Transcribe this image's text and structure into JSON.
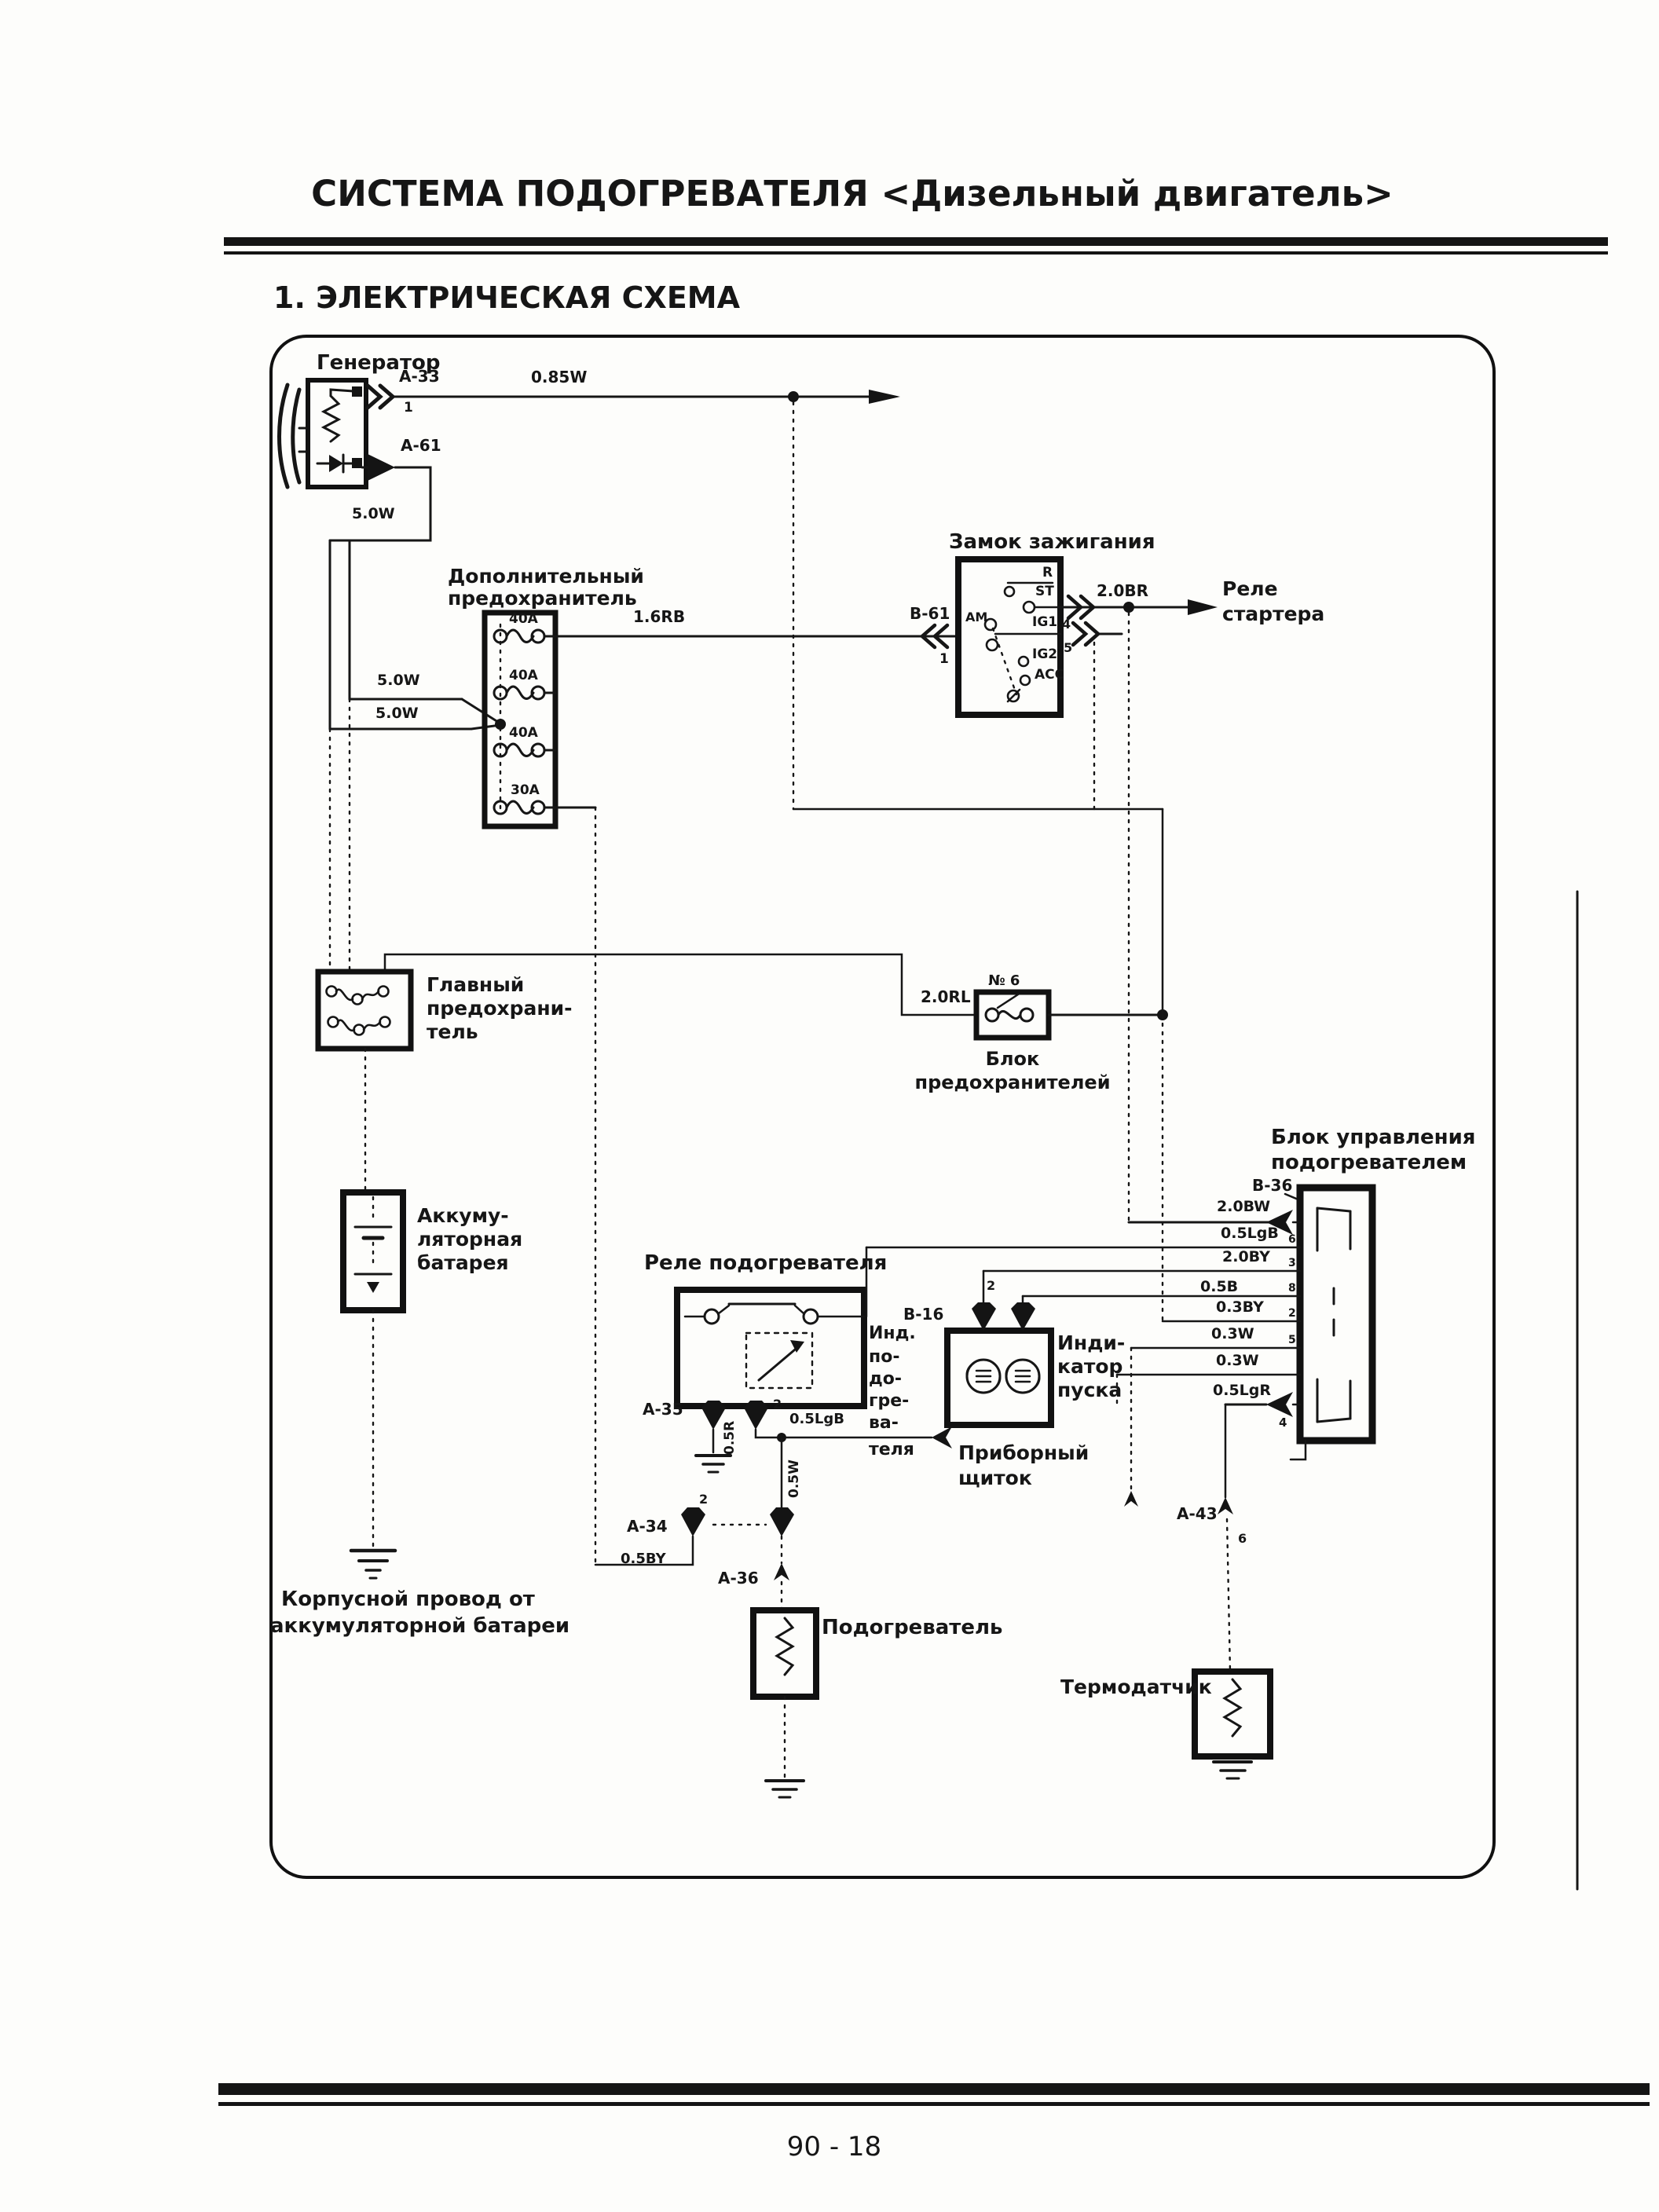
{
  "page": {
    "header_title": "СИСТЕМА ПОДОГРЕВАТЕЛЯ <Дизельный двигатель>",
    "section_title": "1. ЭЛЕКТРИЧЕСКАЯ СХЕМА",
    "page_number": "90 - 18"
  },
  "components": {
    "generator": "Генератор",
    "additional_fuse": [
      "Дополнительный",
      "предохранитель"
    ],
    "ignition_switch": "Замок зажигания",
    "starter_relay": [
      "Реле",
      "стартера"
    ],
    "main_fuse": [
      "Главный",
      "предохрани-",
      "тель"
    ],
    "fuse_block": [
      "Блок",
      "предохранителей"
    ],
    "battery": [
      "Аккуму-",
      "ляторная",
      "батарея"
    ],
    "body_wire_note": [
      "Корпусной провод от",
      "аккумуляторной батареи"
    ],
    "heater_relay": "Реле подогревателя",
    "heater_indicator": [
      "Инд.",
      "по-",
      "до-",
      "гре-",
      "ва-",
      "теля"
    ],
    "start_indicator": [
      "Инди-",
      "катор",
      "пуска"
    ],
    "instrument_panel": [
      "Приборный",
      "щиток"
    ],
    "control_unit": [
      "Блок управления",
      "подогревателем"
    ],
    "heater": "Подогреватель",
    "thermo_sensor": "Термодатчик"
  },
  "connectors": {
    "a33": "A-33",
    "a61": "A-61",
    "b61": "B-61",
    "a35": "A-35",
    "a34": "A-34",
    "a36": "A-36",
    "a43": "A-43",
    "b16": "B-16",
    "b36": "B-36"
  },
  "ignition_contacts": {
    "r": "R",
    "st": "ST",
    "ig1": "IG1",
    "ig2": "IG2",
    "acc": "ACC",
    "am": "AM"
  },
  "fuses": {
    "fuse1": "40A",
    "fuse2": "40A",
    "fuse3": "40A",
    "fuse4": "30A",
    "block_fuse_no": "№ 6"
  },
  "wires": {
    "gen_output": "0.85W",
    "gen_branch": "5.0W",
    "fuse_feed_upper": "5.0W",
    "fuse_feed_lower": "5.0W",
    "ignition_feed": "1.6RB",
    "starter_wire": "2.0BR",
    "fuse_block_wire": "2.0RL",
    "relay_lamp_wire": "0.5LgB",
    "relay_ground_wire": "0.5R",
    "heater_wire": "0.5W",
    "glow_return_wire": "0.5BY",
    "cu_rows": [
      "2.0BW",
      "0.5LgB",
      "2.0BY",
      "0.5B",
      "0.3BY",
      "0.3W",
      "0.3W",
      "0.5LgR"
    ]
  },
  "pins": {
    "a33_pin": "1",
    "b61_pin": "1",
    "ig_pin_4": "4",
    "ig_pin_5": "5",
    "a35_pin": "2",
    "a34_pin": "2",
    "b16_pin": "2",
    "a43_pin": "6",
    "cu_row2": "6",
    "cu_row3": "3",
    "cu_row4": "8",
    "cu_row5": "2",
    "cu_row6": "5",
    "cu_row8": "4"
  }
}
